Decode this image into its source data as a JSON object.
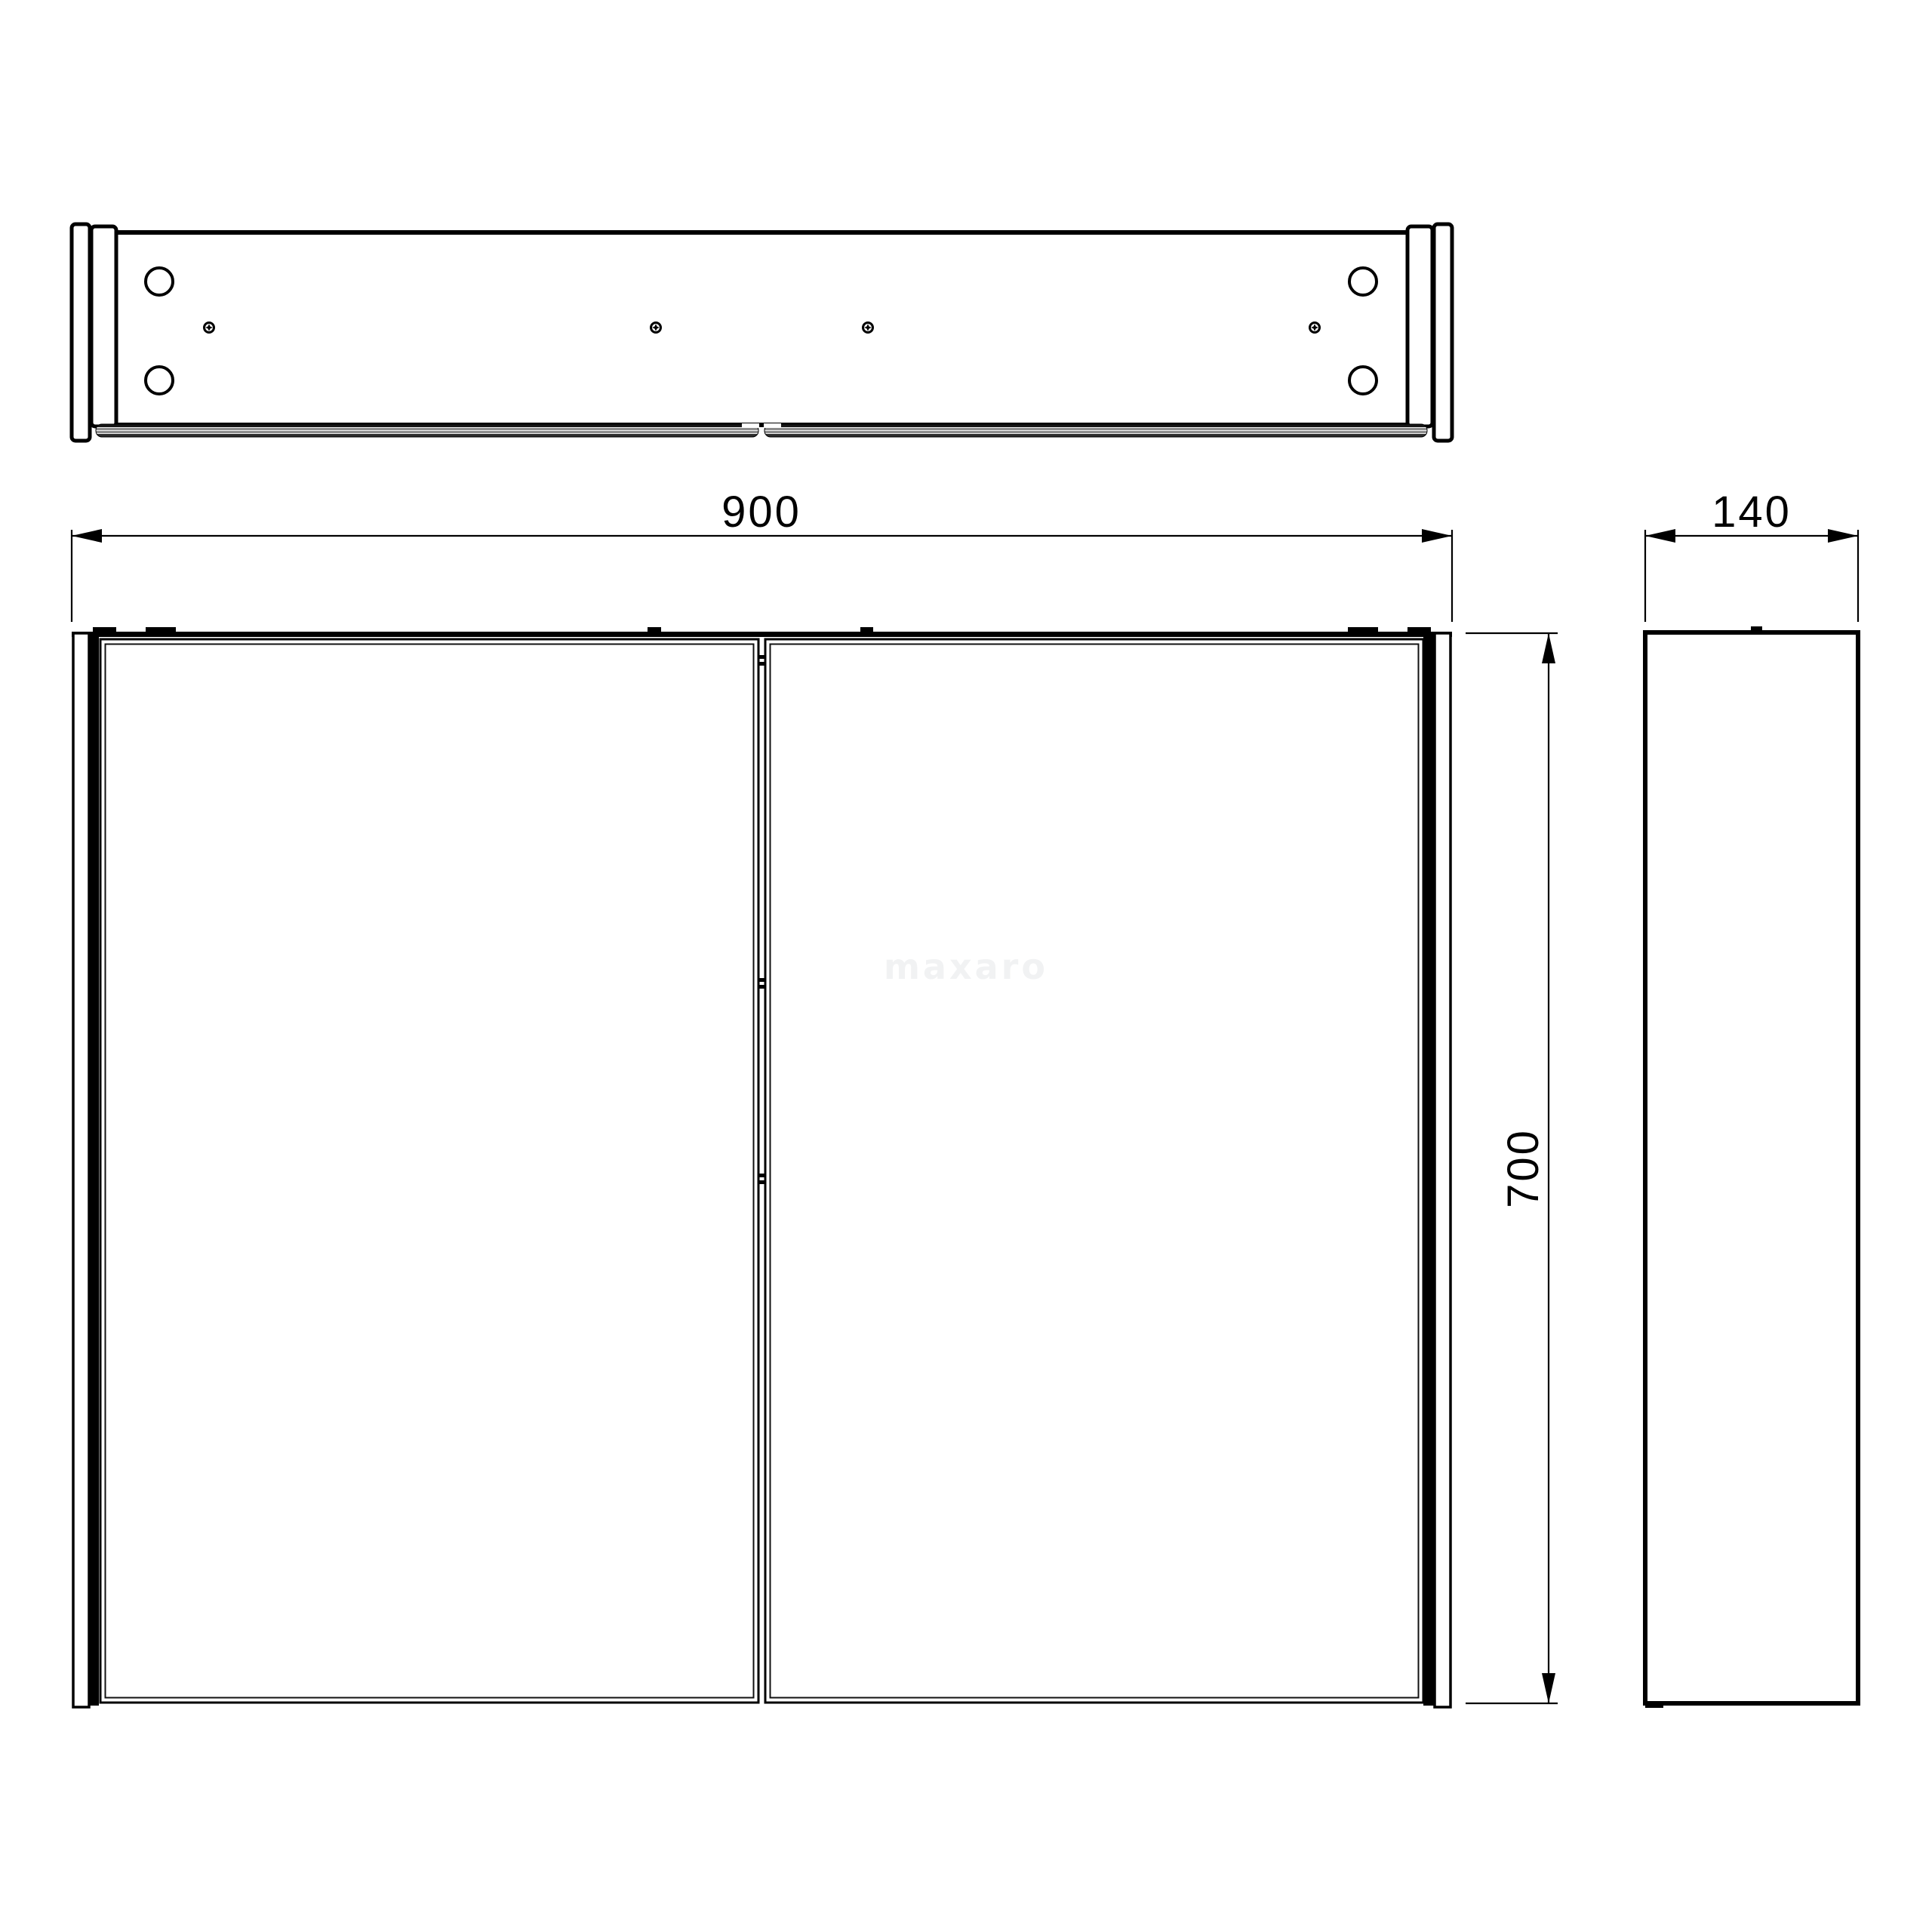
{
  "page": {
    "type": "technical-drawing",
    "subject": "mirror-cabinet-orthographic-views",
    "background": "#ffffff"
  },
  "views": {
    "top": "top-view",
    "front": "front-view",
    "side": "side-view"
  },
  "dimensions": {
    "width": {
      "value": "900"
    },
    "depth": {
      "value": "140"
    },
    "height": {
      "value": "700"
    }
  },
  "watermark": {
    "text": "maxaro",
    "color": "#f1f2f3"
  },
  "colors": {
    "line": "#000000",
    "mirror_edge_black": "#161616",
    "mirror_edge_gray": "#8c8c8c",
    "background": "#ffffff"
  },
  "icons": {
    "screw": "phillips-screw-top-icon",
    "hole": "mounting-hole-icon"
  }
}
